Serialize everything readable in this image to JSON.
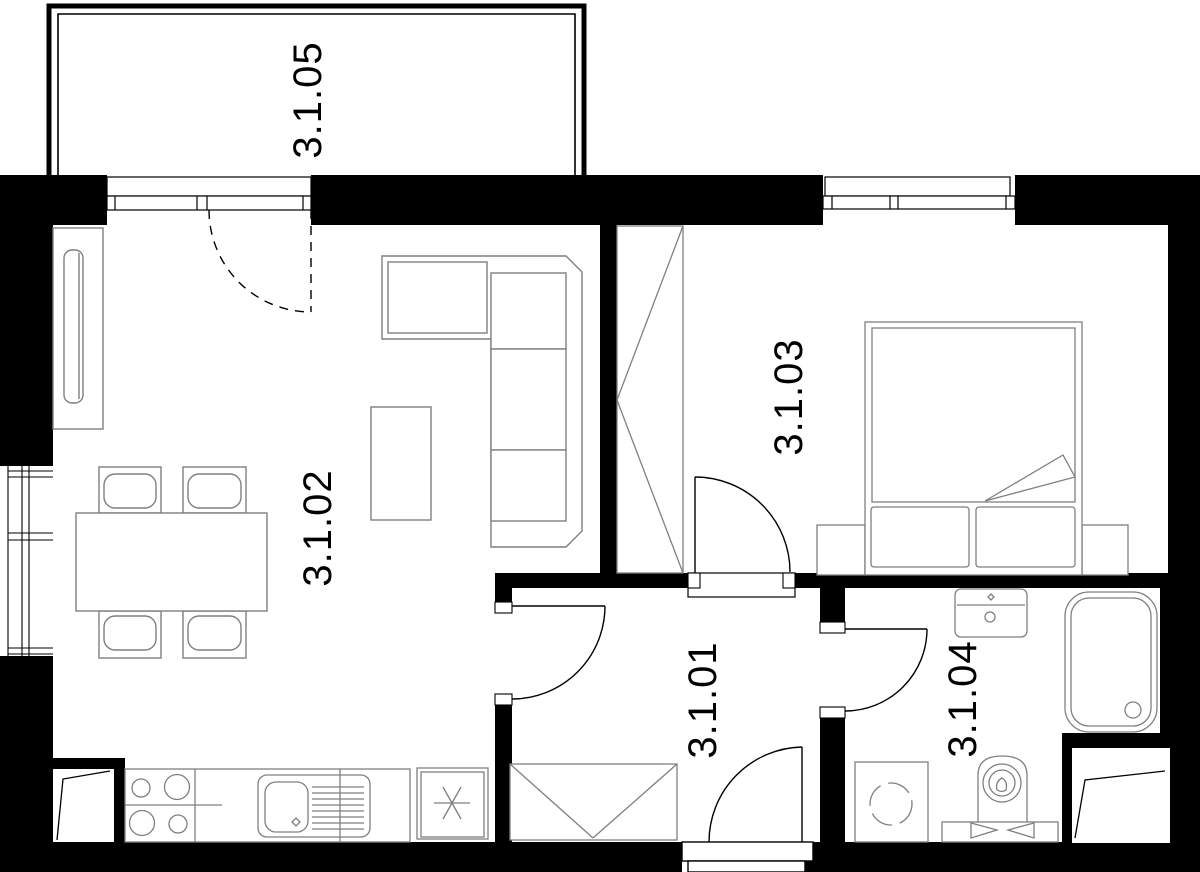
{
  "colors": {
    "walls": "#000000",
    "furniture_lines": "#7f7f7f",
    "door_lines": "#000000",
    "text": "#000000",
    "background": "#ffffff"
  },
  "rooms": [
    {
      "label": "3.1.01",
      "type": "hallway",
      "furniture": [
        "built-in-closet",
        "entry-door",
        "door-to-living-room",
        "door-to-bathroom"
      ]
    },
    {
      "label": "3.1.02",
      "type": "living-room-kitchen",
      "furniture": [
        "tv-cabinet",
        "corner-sofa",
        "coffee-table",
        "dining-table",
        "4-chairs",
        "hob",
        "kitchen-sink",
        "fridge",
        "balcony-door",
        "window"
      ]
    },
    {
      "label": "3.1.03",
      "type": "bedroom",
      "furniture": [
        "wardrobe",
        "double-bed",
        "2-pillows",
        "2-nightstands",
        "window",
        "door"
      ]
    },
    {
      "label": "3.1.04",
      "type": "bathroom",
      "furniture": [
        "vanity-sink",
        "bathtub",
        "washing-machine",
        "toilet",
        "door"
      ]
    },
    {
      "label": "3.1.05",
      "type": "balcony",
      "furniture": []
    }
  ]
}
